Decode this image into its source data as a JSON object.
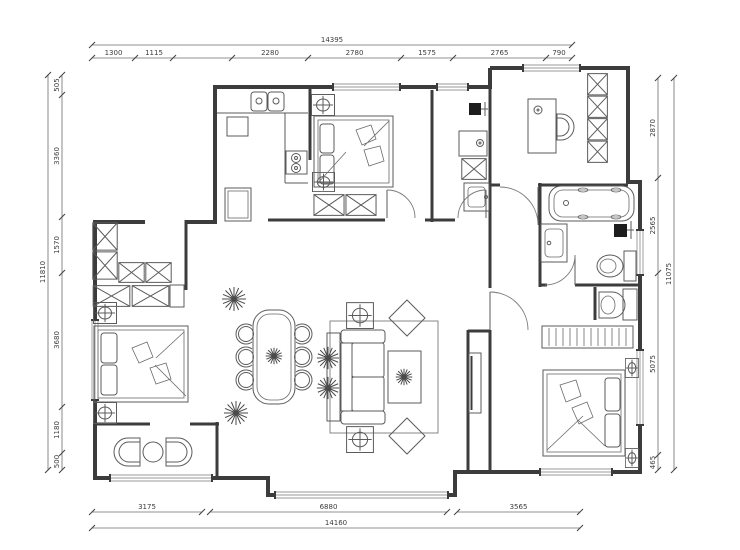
{
  "drawing": {
    "kind": "apartment floor plan",
    "units": "mm",
    "colors": {
      "wall": "#3c3c3c",
      "furniture_line": "#5b5b5b",
      "dimension_line": "#6b6b6b",
      "background": "#ffffff"
    }
  },
  "dimensions": {
    "top": {
      "overall": "14395",
      "segments": [
        "1300",
        "1115",
        "",
        "2280",
        "2780",
        "1575",
        "2765",
        "790"
      ]
    },
    "bottom": {
      "overall": "14160",
      "segments": [
        "3175",
        "6880",
        "3565"
      ]
    },
    "left": {
      "overall": "11810",
      "segments": [
        "505",
        "3360",
        "1570",
        "3680",
        "1180",
        "500"
      ]
    },
    "right": {
      "overall": "11075",
      "segments": [
        "2870",
        "2565",
        "5075",
        "465"
      ]
    }
  },
  "legend": {
    "fixtures": [
      "double-sink",
      "stove",
      "refrigerator",
      "double-bed",
      "pillow",
      "wardrobe",
      "nightstand-lamp",
      "sofa",
      "coffee-table",
      "rug",
      "armchair",
      "tv-unit",
      "dining-table",
      "dining-chair",
      "plant",
      "bathtub",
      "vanity-basin",
      "toilet",
      "wash-basin",
      "washing-machine",
      "laundry-sink",
      "desk",
      "desk-chair",
      "bookshelf",
      "radiator",
      "lounge-chair",
      "balcony-table",
      "water-heater",
      "window",
      "door"
    ]
  }
}
